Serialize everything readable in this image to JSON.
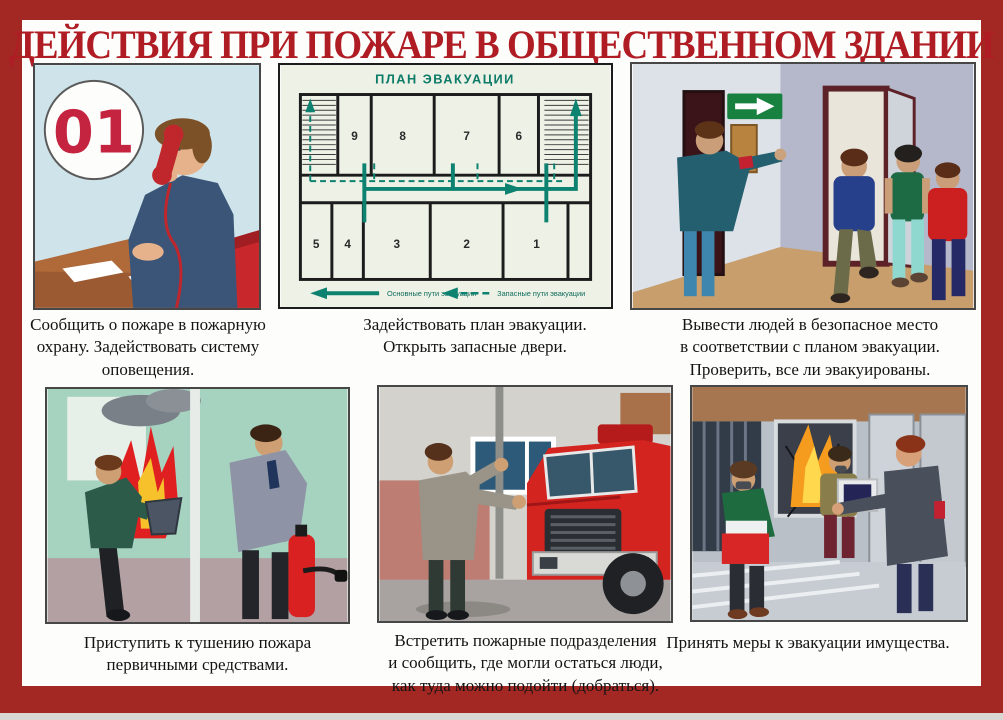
{
  "title": "ДЕЙСТВИЯ ПРИ ПОЖАРЕ В ОБЩЕСТВЕННОМ ЗДАНИИ",
  "emergency_number": "01",
  "colors": {
    "frame_red": "#a32824",
    "title_red": "#b01c23",
    "plan_green": "#0e8270",
    "exit_sign_green": "#18813f",
    "truck_red": "#d42420",
    "fire_red": "#e02020",
    "fire_orange": "#f59b1e",
    "phone_red": "#c0272d",
    "armband_red": "#c32030"
  },
  "panels": {
    "report": {
      "caption": "Сообщить о пожаре в пожарную\nохрану.  Задействовать систему\nоповещения."
    },
    "plan": {
      "caption": "Задействовать план эвакуации.\nОткрыть запасные двери.",
      "title": "ПЛАН ЭВАКУАЦИИ",
      "rooms_top": [
        "9",
        "8",
        "7",
        "6"
      ],
      "rooms_bottom": [
        "5",
        "4",
        "3",
        "2",
        "1"
      ],
      "legend": {
        "main": "Основные пути эвакуации",
        "reserve": "Запасные пути эвакуации"
      }
    },
    "evacuate_people": {
      "caption": "Вывести людей в безопасное место\nв соответствии с планом эвакуации.\nПроверить, все ли эвакуированы."
    },
    "extinguish": {
      "caption": "Приступить к тушению пожара\nпервичными средствами."
    },
    "meet_brigade": {
      "caption": "Встретить пожарные подразделения\nи сообщить, где могли остаться люди,\nкак туда можно подойти (добраться)."
    },
    "evacuate_property": {
      "caption": "Принять меры к эвакуации имущества."
    }
  }
}
